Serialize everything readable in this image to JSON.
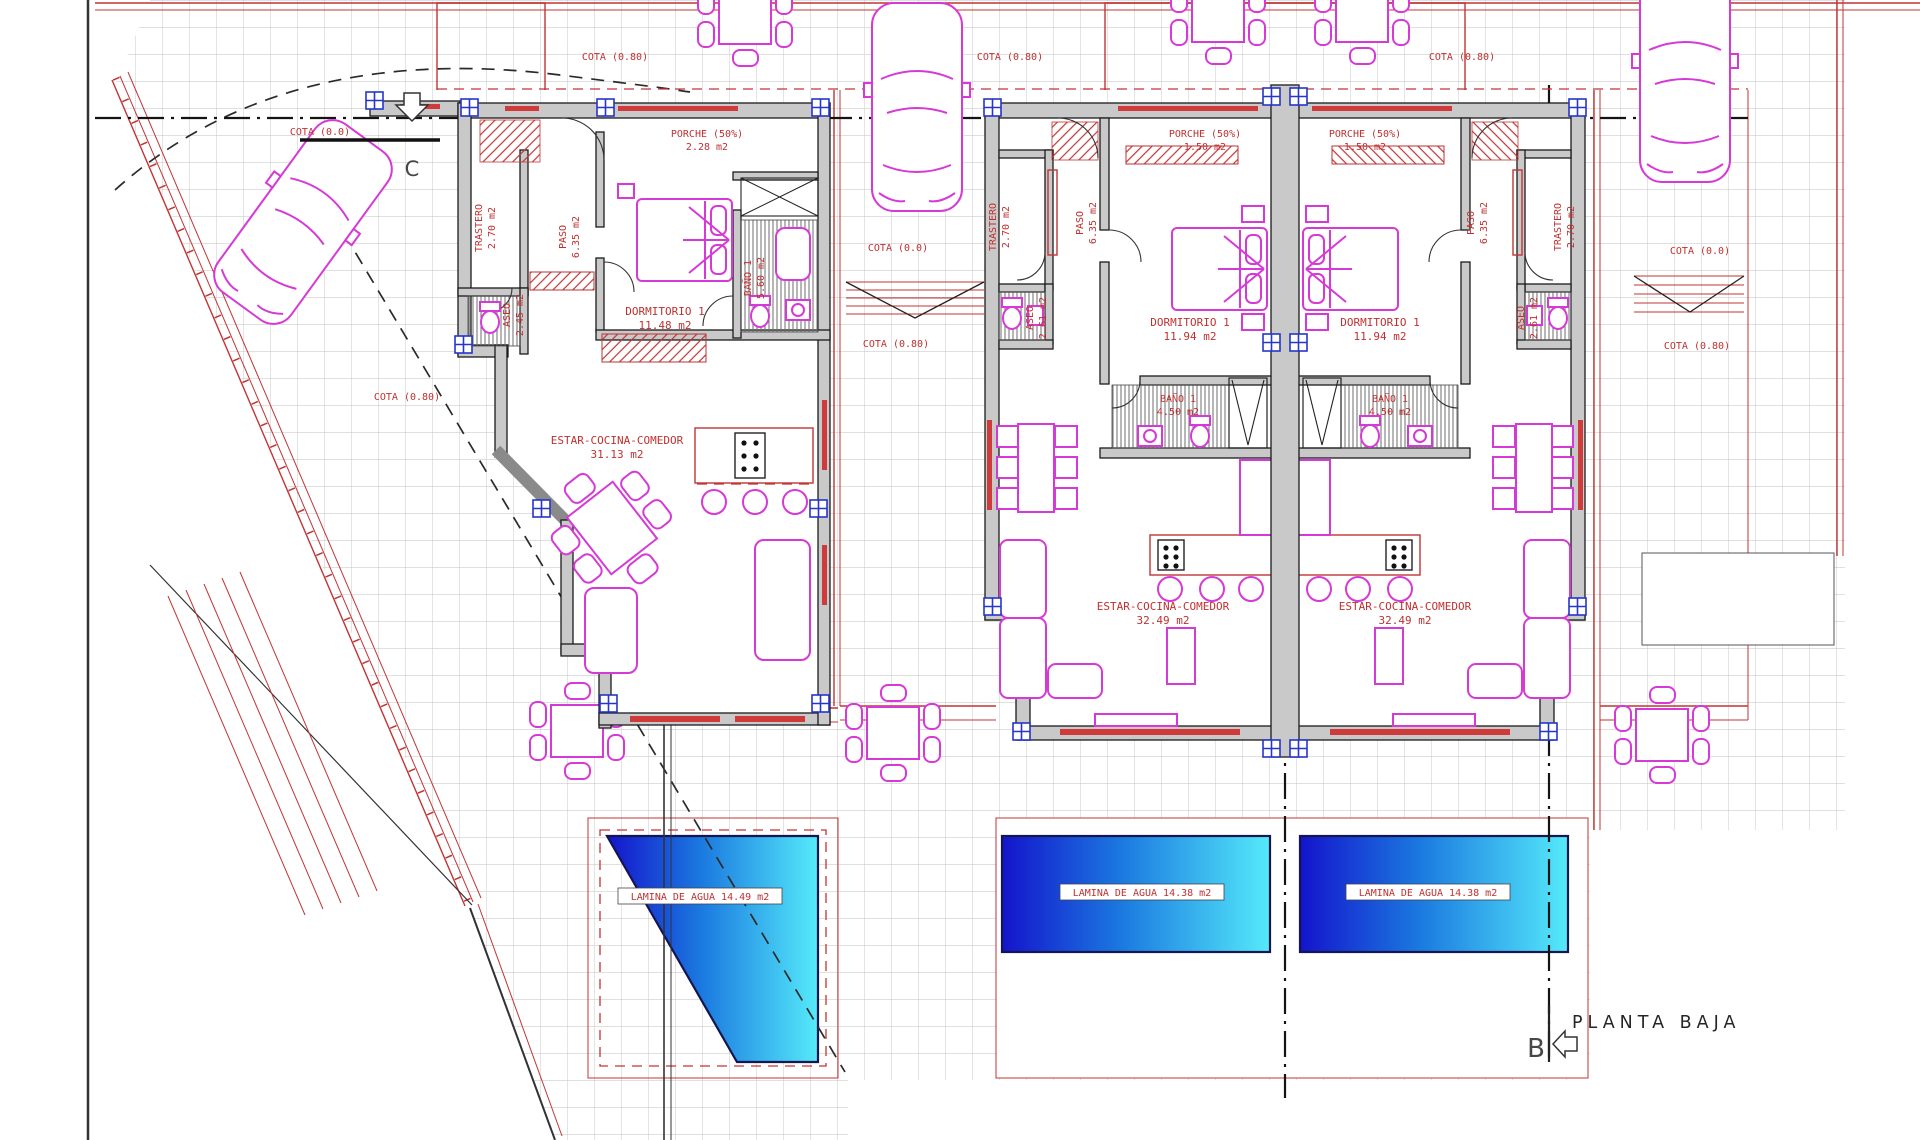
{
  "title": {
    "label": "PLANTA BAJA"
  },
  "section_markers": {
    "b": "B",
    "c": "C"
  },
  "site": {
    "cotas": {
      "left_street": "COTA (0.0)",
      "left_garden": "COTA (0.80)",
      "top_house1": "COTA (0.80)",
      "top_house2": "COTA (0.80)",
      "top_house3": "COTA (0.80)",
      "mid_street": "COTA (0.0)",
      "mid_garden": "COTA (0.80)",
      "right_street": "COTA (0.0)",
      "right_garden": "COTA (0.80)"
    }
  },
  "houses": [
    {
      "id": "house-1",
      "porche": {
        "label": "PORCHE (50%)",
        "area": "2.28 m2"
      },
      "rooms": {
        "trastero": {
          "label": "TRASTERO",
          "area": "2.70 m2"
        },
        "paso": {
          "label": "PASO",
          "area": "6.35 m2"
        },
        "aseo": {
          "label": "ASEO",
          "area": "2.45 m2"
        },
        "dormitorio": {
          "label": "DORMITORIO 1",
          "area": "11.48 m2"
        },
        "bano": {
          "label": "BAÑO 1",
          "area": "5.60 m2"
        },
        "estar": {
          "label": "ESTAR-COCINA-COMEDOR",
          "area": "31.13 m2"
        }
      },
      "pool": {
        "label": "LAMINA DE AGUA 14.49 m2"
      }
    },
    {
      "id": "house-2",
      "porche": {
        "label": "PORCHE (50%)",
        "area": "1.50 m2"
      },
      "rooms": {
        "trastero": {
          "label": "TRASTERO",
          "area": "2.70 m2"
        },
        "paso": {
          "label": "PASO",
          "area": "6.35 m2"
        },
        "aseo": {
          "label": "ASEO",
          "area": "2.61 m2"
        },
        "dormitorio": {
          "label": "DORMITORIO 1",
          "area": "11.94 m2"
        },
        "bano": {
          "label": "BAÑO 1",
          "area": "4.50 m2"
        },
        "estar": {
          "label": "ESTAR-COCINA-COMEDOR",
          "area": "32.49 m2"
        }
      },
      "pool": {
        "label": "LAMINA DE AGUA 14.38 m2"
      }
    },
    {
      "id": "house-3",
      "porche": {
        "label": "PORCHE (50%)",
        "area": "1.50 m2"
      },
      "rooms": {
        "trastero": {
          "label": "TRASTERO",
          "area": "2.70 m2"
        },
        "paso": {
          "label": "PASO",
          "area": "6.35 m2"
        },
        "aseo": {
          "label": "ASEO",
          "area": "2.61 m2"
        },
        "dormitorio": {
          "label": "DORMITORIO 1",
          "area": "11.94 m2"
        },
        "bano": {
          "label": "BAÑO 1",
          "area": "4.50 m2"
        },
        "estar": {
          "label": "ESTAR-COCINA-COMEDOR",
          "area": "32.49 m2"
        }
      },
      "pool": {
        "label": "LAMINA DE AGUA 14.38 m2"
      }
    }
  ],
  "colors": {
    "label_red": "#c03030",
    "boundary_red": "#c23434",
    "furniture_magenta": "#d63ad6",
    "wall_gray": "#c9c9c9",
    "window_blue": "#2636c8",
    "pool_blue_dark": "#1414cc",
    "pool_cyan": "#55eafa",
    "grid_gray": "#c2c2c2"
  }
}
